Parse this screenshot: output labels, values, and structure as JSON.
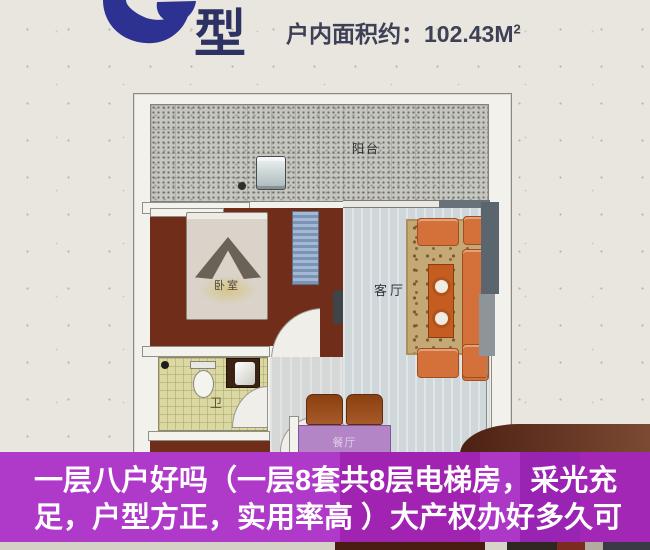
{
  "header": {
    "unit_type_char": "型",
    "area_label": "户内面积约：",
    "area_value": "102.43",
    "area_unit": "M",
    "area_exponent": "2"
  },
  "floorplan": {
    "rooms": [
      {
        "id": "balcony",
        "label": "阳台"
      },
      {
        "id": "bedroom",
        "label": "卧室"
      },
      {
        "id": "living-room",
        "label": "客厅"
      },
      {
        "id": "bathroom",
        "label": "卫"
      },
      {
        "id": "dining-room",
        "label": "餐厅"
      }
    ]
  },
  "banner": {
    "lines": [
      "一层八户好吗（一层8套共8层电梯房，采光充",
      "足，户型方正，实用率高 ）大产权办好多久可"
    ]
  },
  "colors": {
    "brand_blue": "#2c3192",
    "title_navy": "#2d3263",
    "banner_purple": "#a823c8",
    "banner_text": "#ffffff",
    "wall_maroon": "#6f2d1a",
    "sofa_orange": "#d4713a",
    "dining_purple": "#b485c6",
    "bathroom_yellow": "#dcd8a2",
    "living_floor": "#cfd7db"
  }
}
